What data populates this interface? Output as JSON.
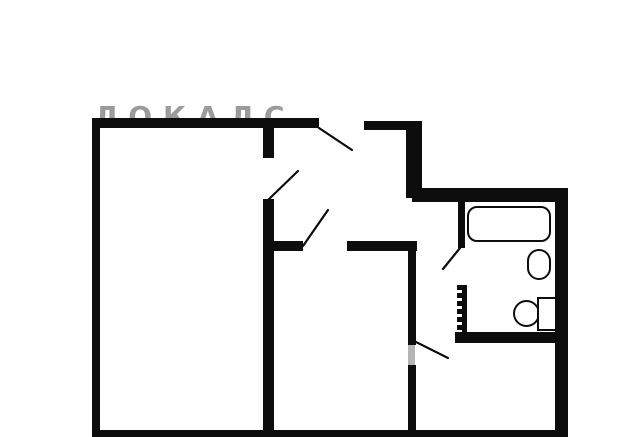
{
  "figure": {
    "type": "floor-plan",
    "watermark": {
      "text": "ЛОКАЛС"
    }
  },
  "colors": {
    "wall": "#0d0d0d",
    "bg": "#ffffff",
    "watermark": "#9b9b9b",
    "opening": "#b5b5b5"
  },
  "fixtures": [
    {
      "icon": "bathtub-icon"
    },
    {
      "icon": "sink-icon"
    },
    {
      "icon": "toilet-icon"
    },
    {
      "icon": "radiator-hatch-icon"
    }
  ],
  "doors": {
    "count": 5
  }
}
